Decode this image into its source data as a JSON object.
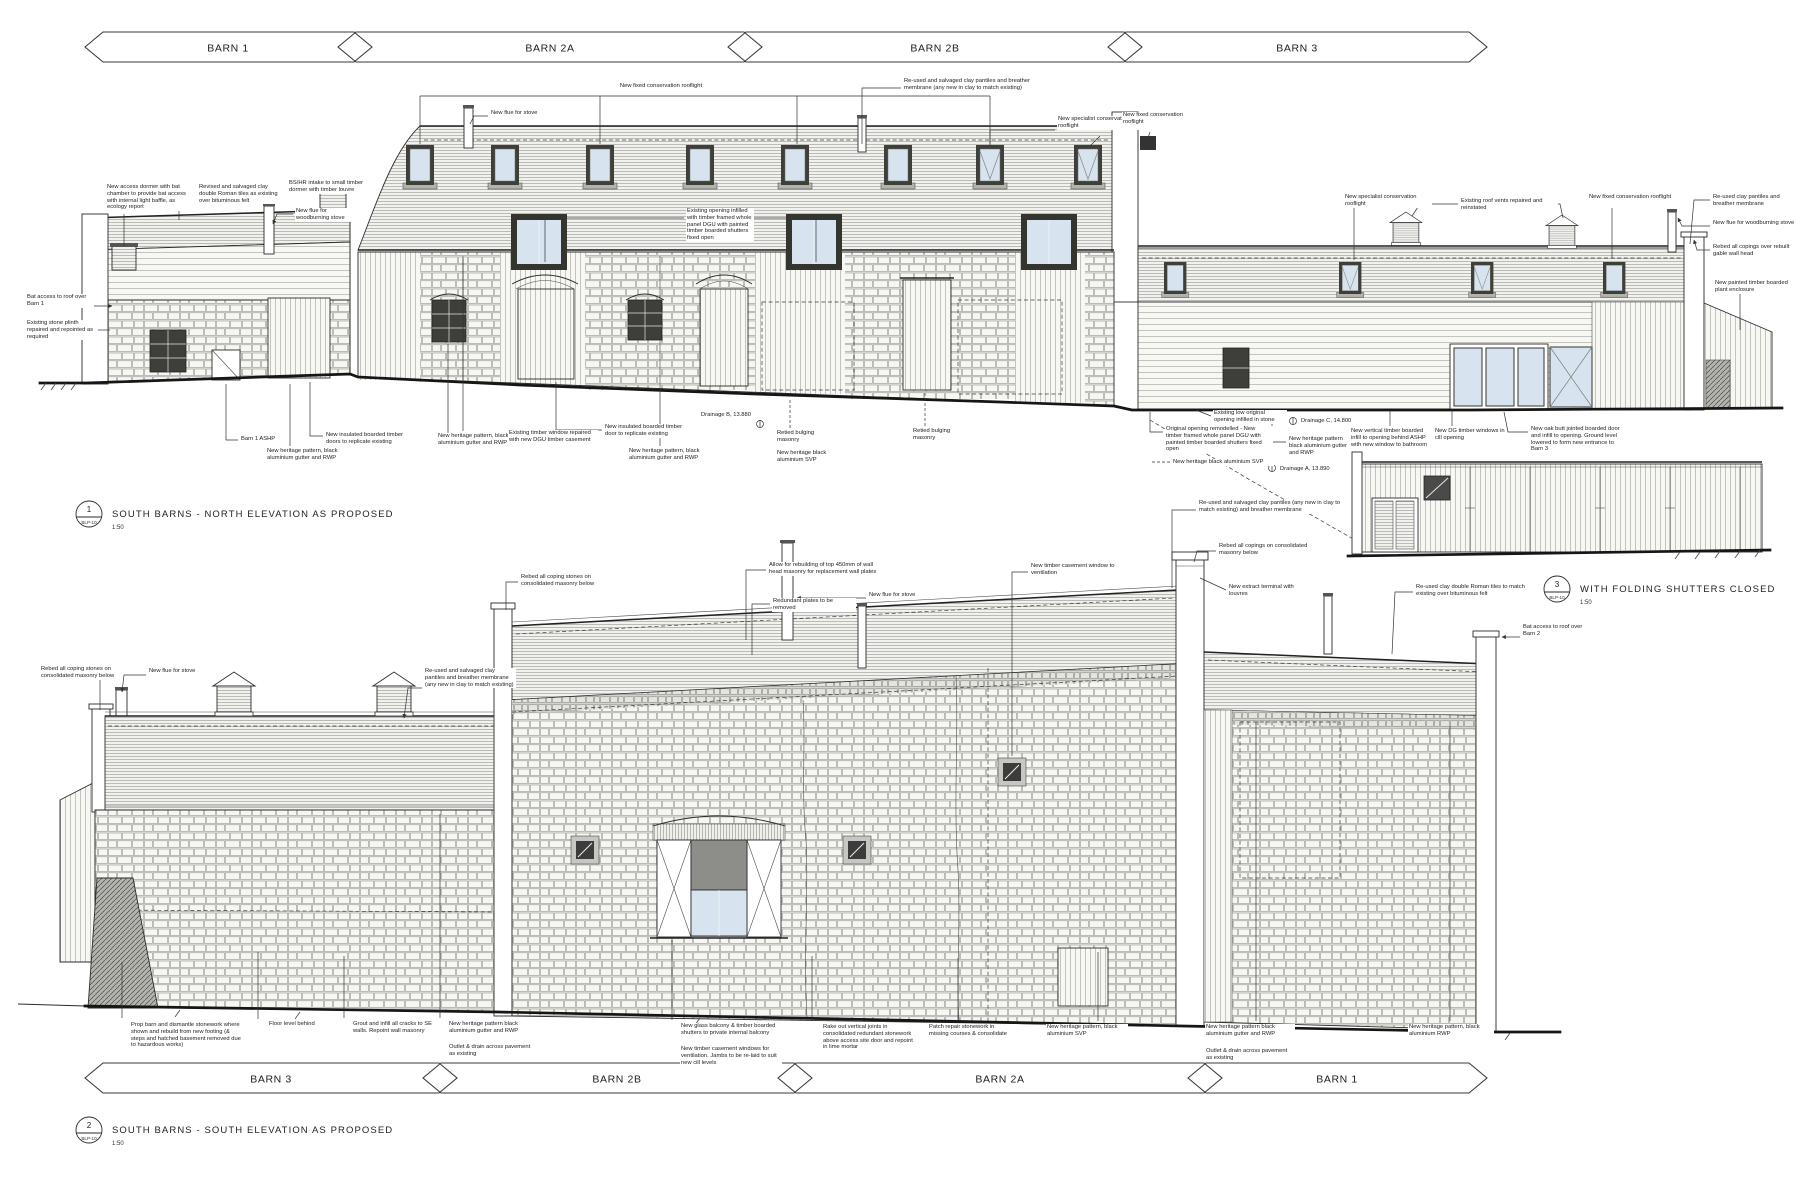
{
  "sheet": {
    "background": "#ffffff",
    "line_color": "#2b2b2b",
    "glass_color": "#d7e4ef",
    "shutter_panel_color": "#8d8d8a",
    "stone_color": "#e9e9e5"
  },
  "banners_top": [
    {
      "label": "BARN 1"
    },
    {
      "label": "BARN 2A"
    },
    {
      "label": "BARN 2B"
    },
    {
      "label": "BARN 3"
    }
  ],
  "banners_bottom": [
    {
      "label": "BARN 3"
    },
    {
      "label": "BARN 2B"
    },
    {
      "label": "BARN 2A"
    },
    {
      "label": "BARN 1"
    }
  ],
  "titles": [
    {
      "num": "1",
      "ref": "BLP-10",
      "label": "SOUTH BARNS - NORTH ELEVATION AS PROPOSED",
      "scale": "1:50"
    },
    {
      "num": "2",
      "ref": "BLP-10",
      "label": "SOUTH BARNS - SOUTH ELEVATION AS PROPOSED",
      "scale": "1:50"
    },
    {
      "num": "3",
      "ref": "BLP-10",
      "label": "WITH FOLDING SHUTTERS CLOSED",
      "scale": "1:50"
    }
  ],
  "annotations": [
    {
      "t": "Bat access to roof over Barn 1",
      "x": 26,
      "y": 294,
      "w": 66,
      "lead": "94,306 112,306",
      "arrow": true
    },
    {
      "t": "New access dormer with bat chamber to provide bat access with internal light baffle, as ecology report",
      "x": 106,
      "y": 184,
      "w": 88,
      "lead": "124,214 124,246"
    },
    {
      "t": "Revised and salvaged clay double Roman tiles as existing over bituminous felt",
      "x": 198,
      "y": 184,
      "w": 84,
      "lead": "196,190 179,190 179,220"
    },
    {
      "t": "BS/HR intake to small timber dormer with timber louvre",
      "x": 288,
      "y": 180,
      "w": 80,
      "lead": "350,186 368,186"
    },
    {
      "t": "New flue for woodburning stove",
      "x": 295,
      "y": 208,
      "w": 62,
      "lead": "293,214 277,214 273,224",
      "arrow": true
    },
    {
      "t": "Existing stone plinth repaired and repointed as required",
      "x": 26,
      "y": 320,
      "w": 70,
      "lead": "96,330 110,330"
    },
    {
      "t": "New fixed conservation rooflight",
      "x": 565,
      "y": 83,
      "w": 190,
      "c": true,
      "leads": [
        "420,96 990,96",
        "420,96 420,144",
        "600,96 600,144",
        "797,96 797,144",
        "990,96 990,144"
      ]
    },
    {
      "t": "New flue for stove",
      "x": 490,
      "y": 110,
      "w": 56,
      "lead": "488,116 474,116 470,124"
    },
    {
      "t": "Re-used and salvaged clay pantiles and breather membrane (any new in clay to match existing)",
      "x": 903,
      "y": 78,
      "w": 155,
      "lead": "901,88 862,88 862,144"
    },
    {
      "t": "New specialist conservation rooflight",
      "x": 1057,
      "y": 116,
      "w": 92,
      "leads": [
        "1055,130 990,130 990,146",
        "1100,136 1090,146"
      ]
    },
    {
      "t": "New fixed conservation rooflight",
      "x": 1122,
      "y": 112,
      "w": 78,
      "lead": "1150,132 1148,138"
    },
    {
      "t": "New specialist conservation rooflight",
      "x": 1344,
      "y": 194,
      "w": 86,
      "lead": "1354,208 1354,260"
    },
    {
      "t": "Existing roof vents repaired and reinstated",
      "x": 1460,
      "y": 198,
      "w": 96,
      "leads": [
        "1458,204 1420,204 1412,216",
        "1542,204 1560,204 1563,218"
      ]
    },
    {
      "t": "New fixed conservation rooflight",
      "x": 1588,
      "y": 194,
      "w": 84,
      "lead": "1612,208 1612,258"
    },
    {
      "t": "Re-used clay pantiles and breather membrane",
      "x": 1712,
      "y": 194,
      "w": 82,
      "lead": "1710,200 1694,200 1690,244"
    },
    {
      "t": "New flue for woodburning stove",
      "x": 1712,
      "y": 220,
      "w": 82,
      "lead": "1710,226 1682,226 1678,218",
      "arrow": true
    },
    {
      "t": "Rebed all copings over rebuilt gable wall head",
      "x": 1712,
      "y": 244,
      "w": 82,
      "lead": "1710,250 1697,250 1694,240",
      "arrow": true
    },
    {
      "t": "New painted timber boarded plant enclosure",
      "x": 1714,
      "y": 280,
      "w": 82,
      "lead": "1740,292 1740,330"
    },
    {
      "t": "Existing opening infilled with timber framed whole panel DGU with painted timber boarded shutters fixed open",
      "x": 686,
      "y": 208,
      "w": 66,
      "leads": [
        "684,218 545,218 545,262",
        "754,218 816,218 816,262"
      ]
    },
    {
      "t": "Barn 1 ASHP",
      "x": 240,
      "y": 436,
      "w": 46,
      "lead": "238,440 226,440 226,384"
    },
    {
      "t": "New heritage pattern, black aluminium gutter and RWP",
      "x": 266,
      "y": 448,
      "w": 94,
      "lead": "290,446 290,384"
    },
    {
      "t": "New insulated boarded timber doors to replicate existing",
      "x": 325,
      "y": 432,
      "w": 84,
      "lead": "323,436 310,436 310,382"
    },
    {
      "t": "New heritage pattern, black aluminium gutter and RWP",
      "x": 437,
      "y": 433,
      "w": 94,
      "lead": "463,431 463,258"
    },
    {
      "t": "Existing timber window repaired with new DGU timber casement",
      "x": 508,
      "y": 430,
      "w": 88,
      "lead": "506,436 448,436 448,344"
    },
    {
      "t": "New insulated boarded timber door to replicate existing",
      "x": 604,
      "y": 424,
      "w": 86,
      "lead": "602,430 556,430 556,382"
    },
    {
      "t": "New heritage pattern, black aluminium gutter and RWP",
      "x": 628,
      "y": 448,
      "w": 94,
      "lead": "660,446 660,388"
    },
    {
      "t": "Drainage B, 13.880",
      "x": 700,
      "y": 412,
      "w": 70
    },
    {
      "t": "Retied bulging masonry",
      "x": 776,
      "y": 430,
      "w": 56,
      "lead": "790,428 790,398",
      "dash": true
    },
    {
      "t": "New heritage black aluminium SVP",
      "x": 776,
      "y": 450,
      "w": 70
    },
    {
      "t": "Retied bulging masonry",
      "x": 912,
      "y": 428,
      "w": 56,
      "lead": "925,426 925,392",
      "dash": true
    },
    {
      "t": "Existing low original opening infilled in stone",
      "x": 1213,
      "y": 410,
      "w": 72,
      "lead": "1211,416 1196,410"
    },
    {
      "t": "Original opening remodelled - New timber framed whole panel DGU with painted timber boarded shutters fixed open",
      "x": 1165,
      "y": 426,
      "w": 106,
      "lead": "1163,432 1150,432 1150,412"
    },
    {
      "t": "New heritage black aluminium SVP",
      "x": 1172,
      "y": 459,
      "w": 100,
      "lead": "1170,462 1152,462",
      "dash": true
    },
    {
      "t": "Drainage C, 14.800",
      "x": 1300,
      "y": 418,
      "w": 70
    },
    {
      "t": "New heritage pattern black aluminium gutter and RWP",
      "x": 1288,
      "y": 436,
      "w": 60,
      "lead": "1286,442 1272,442 1272,414"
    },
    {
      "t": "Drainage A, 13.890",
      "x": 1279,
      "y": 466,
      "w": 70
    },
    {
      "t": "New vertical timber boarded infill to opening behind ASHP with new window to bathroom",
      "x": 1350,
      "y": 428,
      "w": 80,
      "lead": "1390,426 1390,410"
    },
    {
      "t": "New DG timber windows in cill opening",
      "x": 1434,
      "y": 428,
      "w": 70,
      "lead": "1452,426 1452,410"
    },
    {
      "t": "New oak butt jointed boarded door and infill to opening. Ground level lowered to form new entrance to Barn 3",
      "x": 1530,
      "y": 426,
      "w": 96,
      "lead": "1528,432 1508,432 1504,412"
    },
    {
      "t": "Rebed all coping stones on consolidated masonry below",
      "x": 520,
      "y": 574,
      "w": 96,
      "lead": "518,582 506,582 506,610"
    },
    {
      "t": "Allow for rebuilding of top 450mm of wall head masonry for replacement wall plates",
      "x": 768,
      "y": 562,
      "w": 112,
      "lead": "766,570 746,570 746,640"
    },
    {
      "t": "Redundant plates to be removed",
      "x": 772,
      "y": 598,
      "w": 82,
      "lead": "770,604 752,604 752,655"
    },
    {
      "t": "New flue for stove",
      "x": 868,
      "y": 592,
      "w": 58,
      "lead": "866,598 797,598",
      "arrow": true
    },
    {
      "t": "New timber casement window to ventilation",
      "x": 1030,
      "y": 563,
      "w": 92,
      "lead": "1028,572 1012,572 1012,756"
    },
    {
      "t": "Re-used and salvaged clay pantiles (any new in clay to match existing) and breather membrane",
      "x": 1198,
      "y": 500,
      "w": 150,
      "lead": "1196,510 1172,510 1172,588"
    },
    {
      "t": "Rebed all copings on consolidated masonry below",
      "x": 1218,
      "y": 543,
      "w": 95,
      "lead": "1216,551 1197,551 1194,562"
    },
    {
      "t": "New extract terminal with louvres",
      "x": 1228,
      "y": 584,
      "w": 80,
      "lead": "1226,590 1200,578"
    },
    {
      "t": "Rebed all coping stones on consolidated masonry below",
      "x": 40,
      "y": 666,
      "w": 74,
      "lead": "112,676 100,676 100,710"
    },
    {
      "t": "New flue for stove",
      "x": 148,
      "y": 668,
      "w": 54,
      "lead": "146,675 124,675 122,692",
      "arrow": true
    },
    {
      "t": "Re-used and salvaged clay pantiles and breather membrane (any new in clay to match existing)",
      "x": 424,
      "y": 668,
      "w": 90,
      "lead": "422,688 408,688 404,718",
      "arrow": true
    },
    {
      "t": "Re-used clay double Roman tiles to match existing over bituminous felt",
      "x": 1415,
      "y": 584,
      "w": 112,
      "lead": "1413,592 1395,592 1392,654"
    },
    {
      "t": "Bat access to roof over Barn 2",
      "x": 1522,
      "y": 624,
      "w": 64,
      "lead": "1520,637 1502,637",
      "arrow": true
    },
    {
      "t": "Prop barn and dismantle stonework where shown and rebuild from new footing (& steps and hatched basement removed due to hazardous works)",
      "x": 130,
      "y": 1022,
      "w": 112,
      "lead": "122,1018 122,962"
    },
    {
      "t": "Floor level behind",
      "x": 268,
      "y": 1021,
      "w": 62,
      "lead": "258,1019 258,952"
    },
    {
      "t": "Grout and infill all cracks to SE walls. Repoint wall masonry",
      "x": 352,
      "y": 1021,
      "w": 86,
      "lead": "344,1018 344,956"
    },
    {
      "t": "New heritage pattern black aluminium gutter and RWP",
      "x": 448,
      "y": 1021,
      "w": 88,
      "lead": "440,1018 440,814"
    },
    {
      "t": "Outlet & drain across pavement as existing",
      "x": 448,
      "y": 1044,
      "w": 88
    },
    {
      "t": "New glass balcony & timber boarded shutters to private internal balcony",
      "x": 680,
      "y": 1023,
      "w": 100,
      "lead": "672,1020 672,940"
    },
    {
      "t": "New timber casement windows for ventilation. Jambs to be re-laid to suit new cill levels",
      "x": 680,
      "y": 1046,
      "w": 100
    },
    {
      "t": "Rake out vertical joints in consolidated redundant stonework above access site door and repoint in lime mortar",
      "x": 822,
      "y": 1024,
      "w": 92,
      "lead": "812,1021 812,956"
    },
    {
      "t": "Patch repair stonework in missing courses & consolidate",
      "x": 928,
      "y": 1024,
      "w": 86,
      "lead": "958,1021 958,958"
    },
    {
      "t": "New heritage pattern, black aluminium SVP",
      "x": 1046,
      "y": 1024,
      "w": 80,
      "lead": "1098,1021 1098,952"
    },
    {
      "t": "New heritage pattern black aluminium gutter and RWP",
      "x": 1205,
      "y": 1024,
      "w": 88,
      "lead": "1256,1021 1256,722"
    },
    {
      "t": "Outlet & drain across pavement as existing",
      "x": 1205,
      "y": 1048,
      "w": 88
    },
    {
      "t": "New heritage pattern, black aluminium RWP",
      "x": 1408,
      "y": 1024,
      "w": 84,
      "lead": "1450,1021 1450,726"
    }
  ]
}
